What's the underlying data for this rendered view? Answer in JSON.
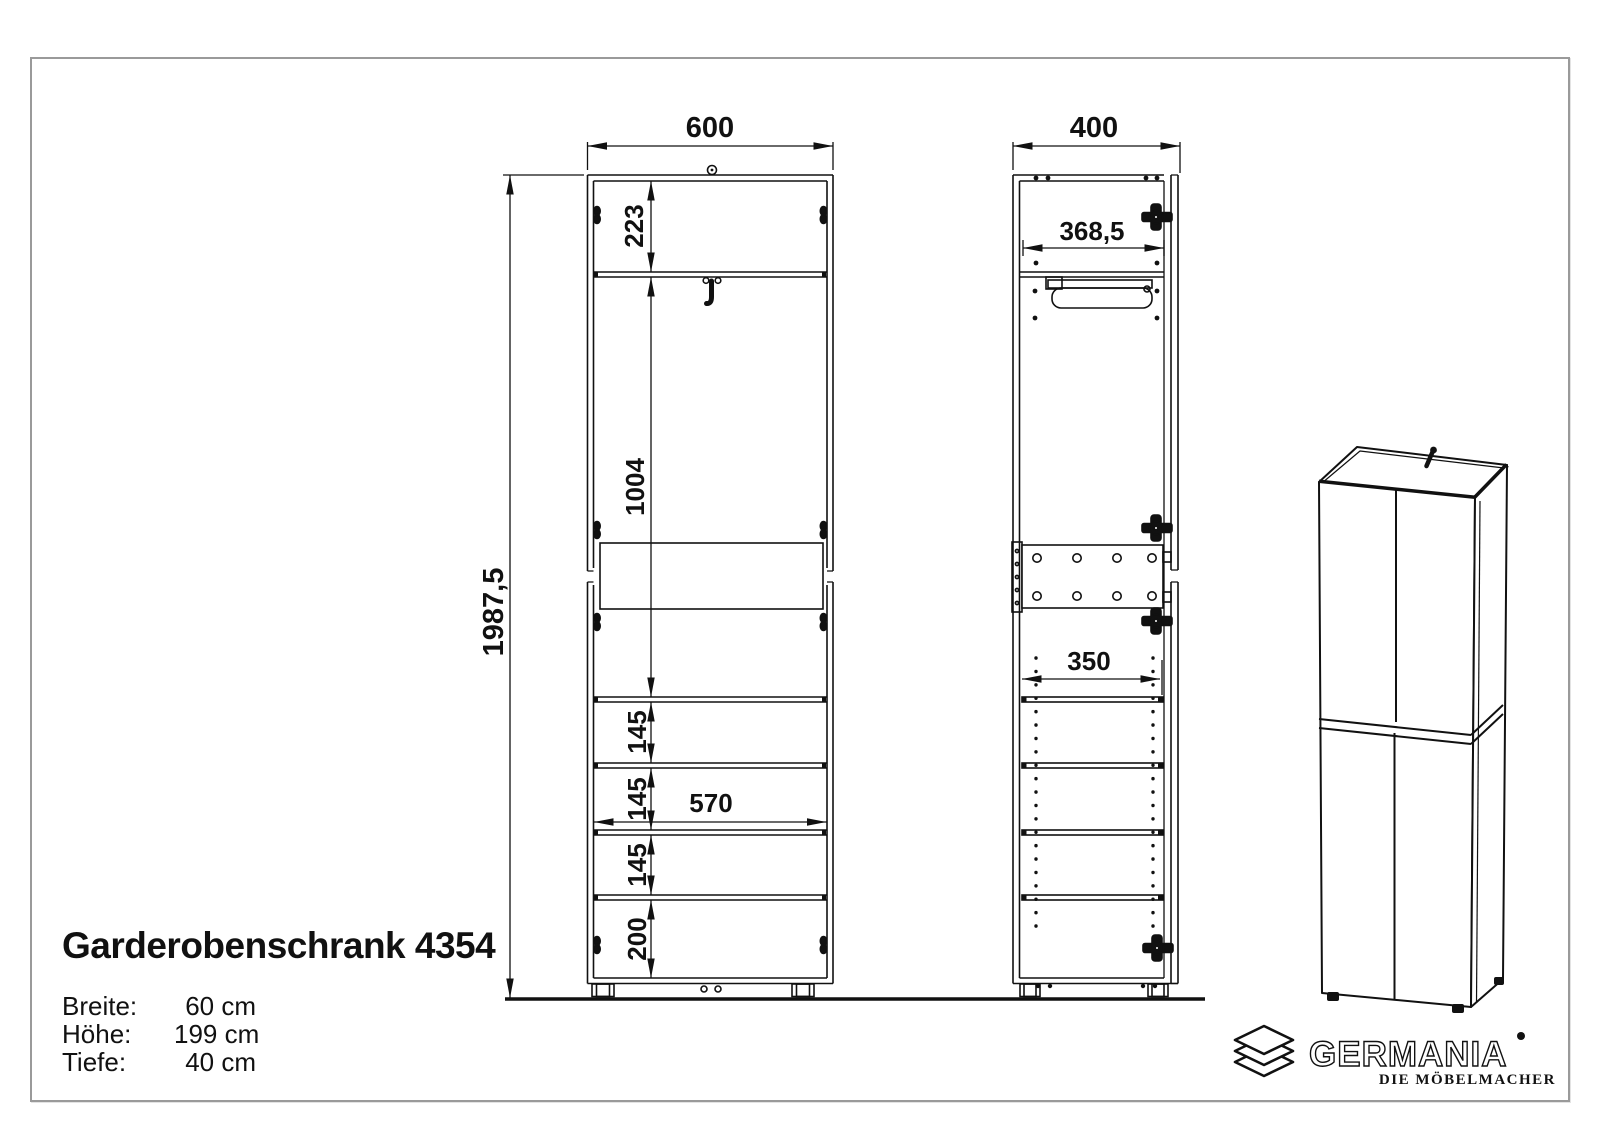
{
  "drawing": {
    "title": "Garderobenschrank 4354",
    "specs": [
      {
        "label": "Breite:",
        "value": "60 cm"
      },
      {
        "label": "Höhe:",
        "value": "199 cm"
      },
      {
        "label": "Tiefe:",
        "value": "40 cm"
      }
    ],
    "front_view": {
      "width": "600",
      "total_height": "1987,5",
      "top_compartment": "223",
      "wardrobe_compartment": "1004",
      "shelf_gaps": [
        "145",
        "145",
        "145"
      ],
      "bottom_compartment": "200",
      "inner_width": "570"
    },
    "side_view": {
      "depth": "400",
      "inner_depth": "368,5",
      "shelf_depth": "350"
    },
    "logo": {
      "brand": "GERMANIA",
      "tagline": "DIE MÖBELMACHER"
    },
    "colors": {
      "line": "#111111",
      "frame_border": "#9a9a9a",
      "background": "#ffffff"
    }
  }
}
